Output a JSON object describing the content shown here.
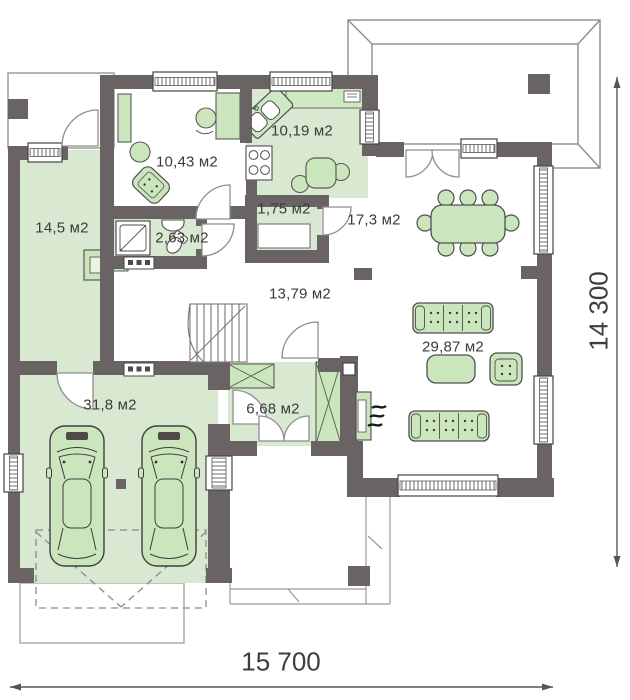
{
  "plan": {
    "type": "floor-plan",
    "rooms": [
      {
        "id": "boiler-room",
        "label": "14,5 м2"
      },
      {
        "id": "mudroom",
        "label": "10,43 м2"
      },
      {
        "id": "kitchen",
        "label": "10,19 м2"
      },
      {
        "id": "pantry",
        "label": "1,75 м2"
      },
      {
        "id": "bathroom",
        "label": "2,63 м2"
      },
      {
        "id": "dining-area",
        "label": "17,3 м2"
      },
      {
        "id": "hall",
        "label": "13,79 м2"
      },
      {
        "id": "garage",
        "label": "31,8 м2"
      },
      {
        "id": "vestibule",
        "label": "6,68 м2"
      },
      {
        "id": "living-room",
        "label": "29,87 м2"
      }
    ],
    "dimensions": {
      "overall_width": "15 700",
      "overall_height": "14 300"
    },
    "colors": {
      "wall": "#6a6364",
      "floor_tint": "#d9e8d1",
      "furniture_fill": "#cbe6bd",
      "outline_gray": "#8d8d8d",
      "text": "#3b3b3b"
    },
    "furniture_icons": [
      "car-icon",
      "dining-table-icon",
      "dining-chair-icon",
      "sofa-icon",
      "armchair-icon",
      "coffee-table-icon",
      "fireplace-icon",
      "stairs-icon",
      "shower-icon",
      "toilet-icon",
      "washbasin-icon",
      "kitchen-sink-icon",
      "stove-icon",
      "microwave-icon",
      "wardrobe-icon",
      "closet-icon",
      "boiler-icon",
      "desk-icon",
      "vent-icon",
      "terrace-icon",
      "driveway-icon",
      "entrance-porch-icon",
      "window-icon",
      "door-icon"
    ]
  }
}
